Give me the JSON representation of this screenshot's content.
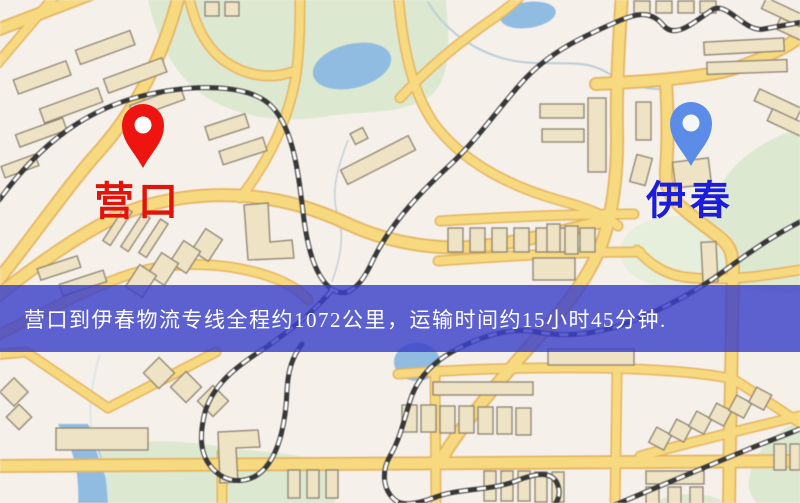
{
  "origin_marker": {
    "name": "营口",
    "pin_color": "#ee1510",
    "label_color": "#e01408"
  },
  "destination_marker": {
    "name": "伊春",
    "pin_color": "#5b8ce8",
    "label_color": "#1c1cdc"
  },
  "banner": {
    "text": "营口到伊春物流专线全程约1072公里，运输时间约15小时45分钟.",
    "background": "rgba(58,63,201,0.82)",
    "text_color": "#ffffff"
  },
  "map_palette": {
    "background": "#f6f0ea",
    "road_fill": "#f8d97b",
    "road_casing": "#e6b45f",
    "building_fill": "#eee3c3",
    "building_outline": "#8d8271",
    "park": "#dce9cf",
    "water": "#8fbce4",
    "railway_dark": "#383838",
    "railway_light": "#ffffff"
  }
}
